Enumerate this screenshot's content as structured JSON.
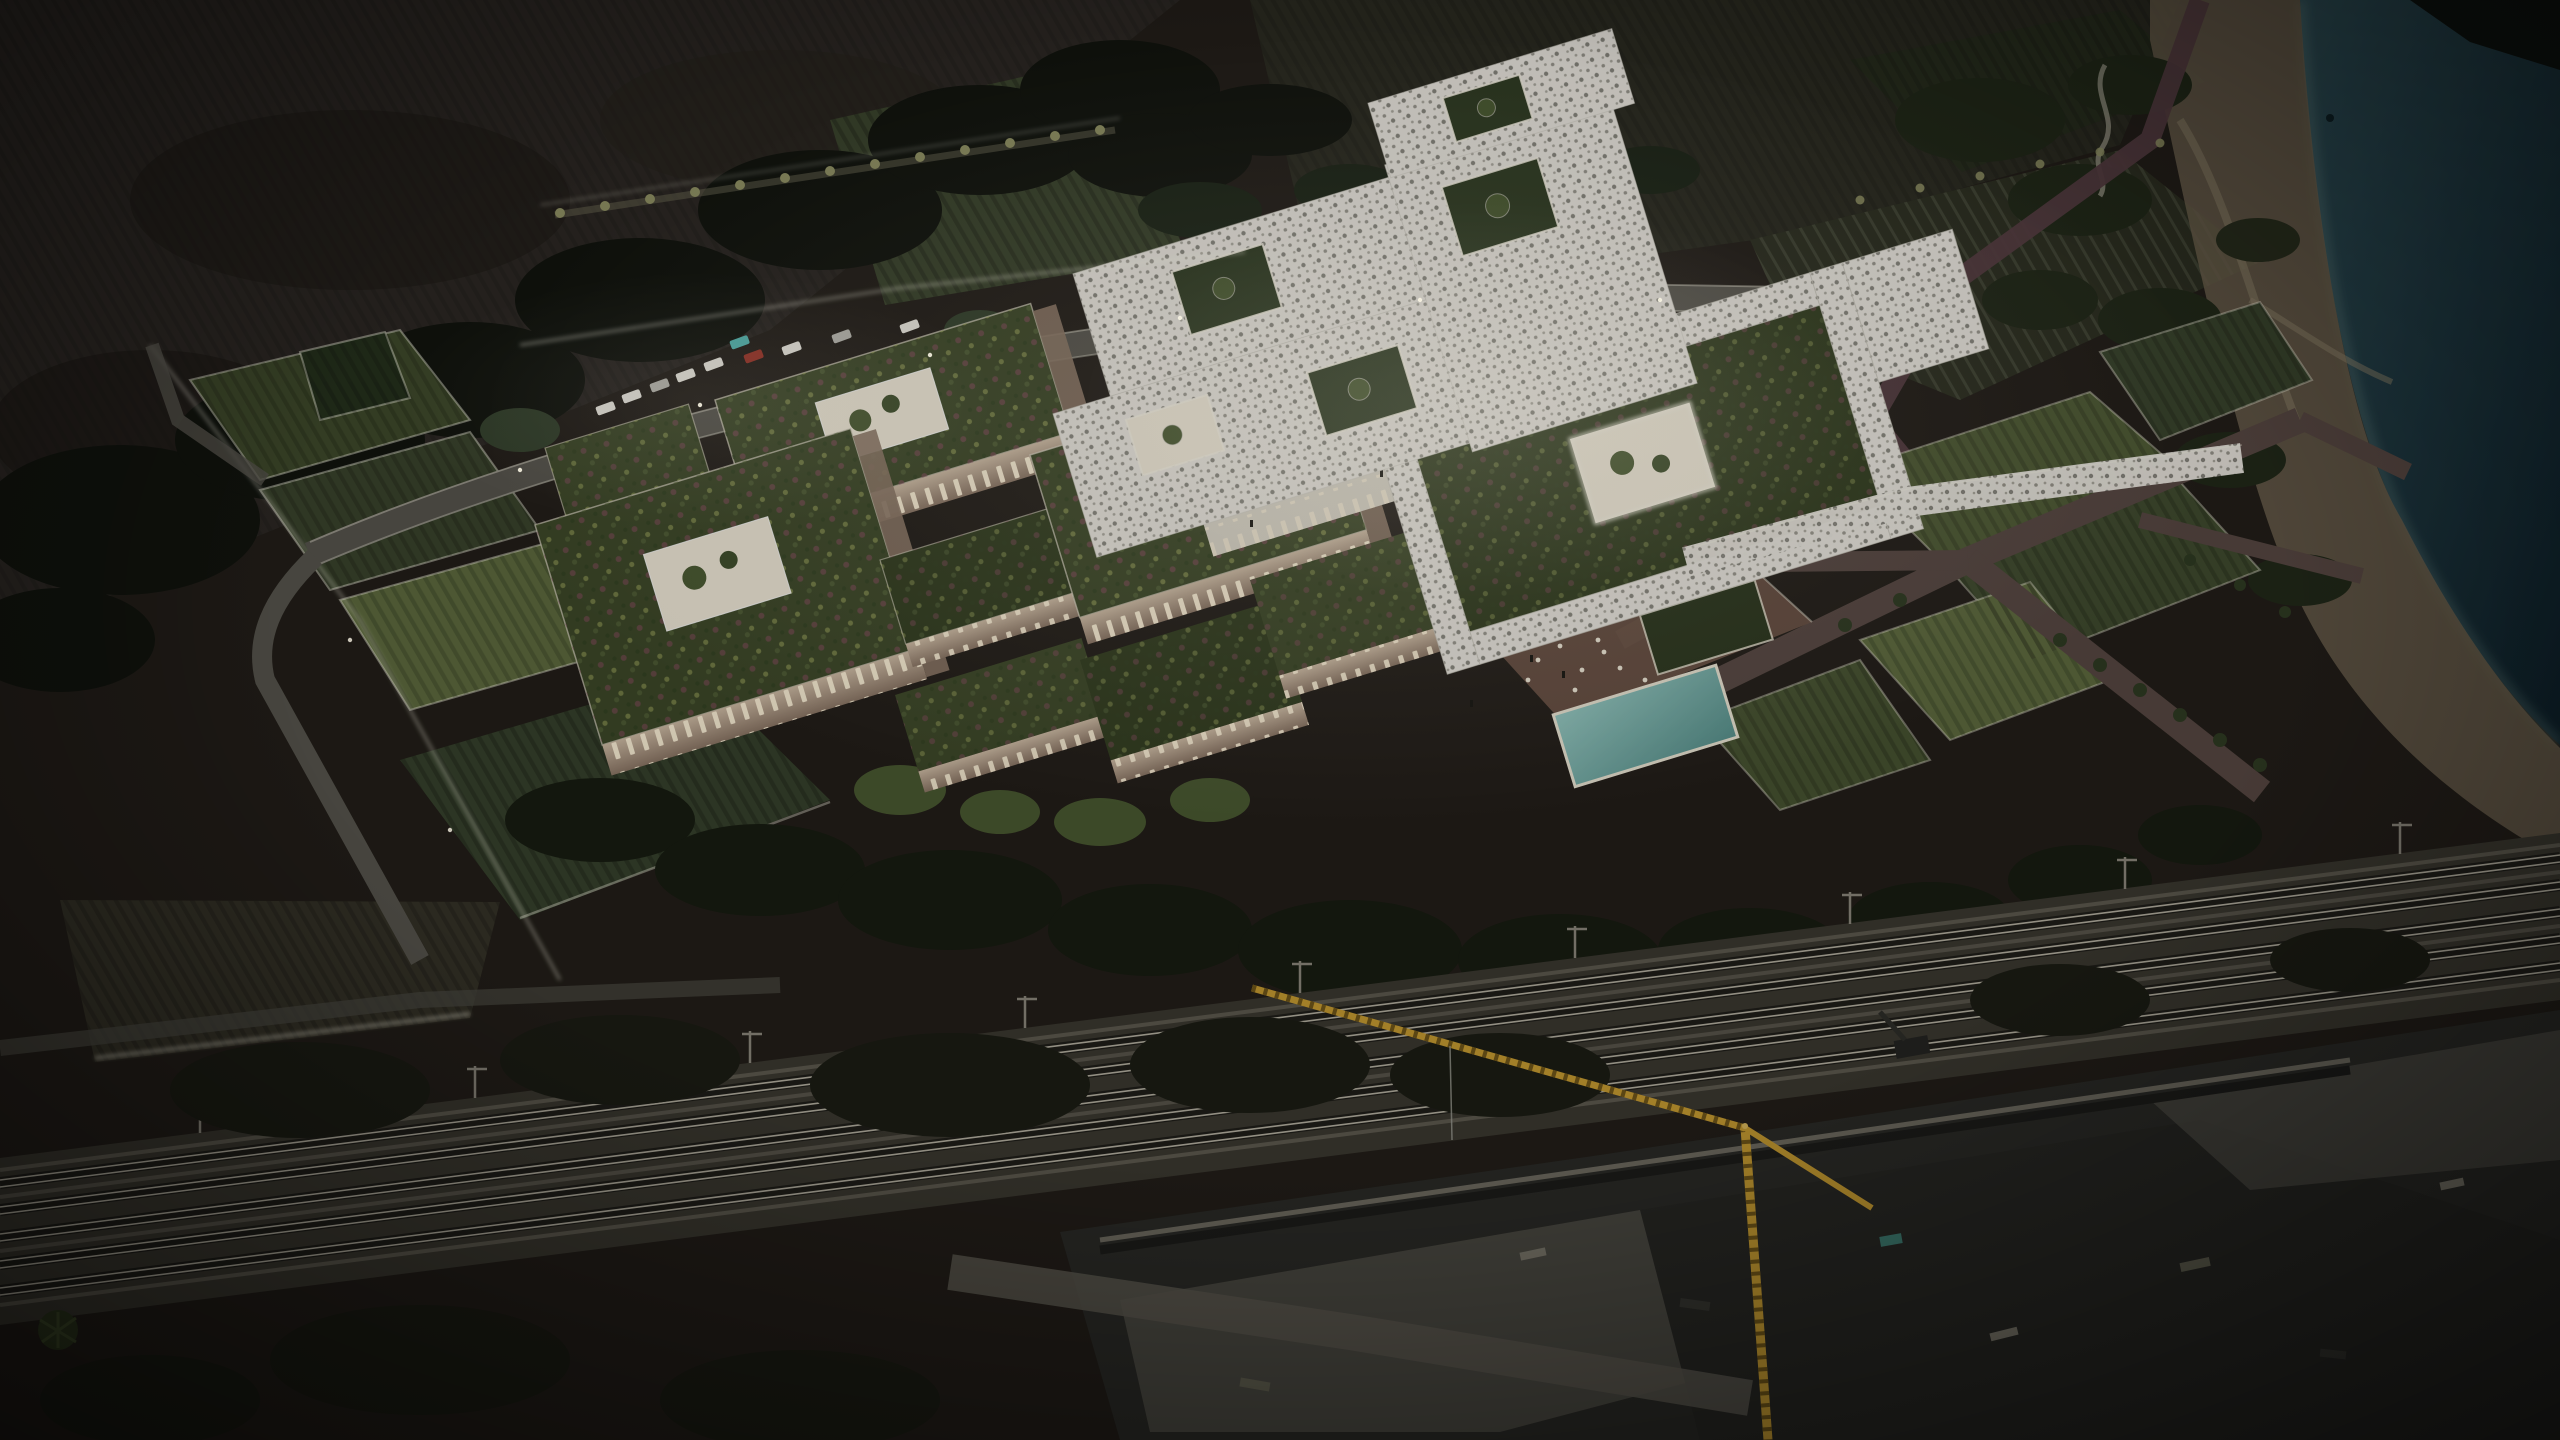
{
  "scene": {
    "type": "night aerial architectural rendering",
    "features": [
      "plowed-fields",
      "scrub-forest",
      "crop-row-plots",
      "palm-allee",
      "campus-courtyard-buildings",
      "green-roofs",
      "white-lattice-canopy",
      "courtyard-palms",
      "main-road",
      "parking-lot",
      "cars",
      "swimming-pool",
      "pool-terrace",
      "cafe-tables",
      "orchard-gardens",
      "terracotta-paths",
      "coastal-dunes",
      "sea",
      "shore-boardwalk",
      "railway-corridor",
      "catenary-masts",
      "construction-site",
      "tower-crane",
      "retaining-walls",
      "perimeter-light-walls"
    ]
  },
  "palette": {
    "earth": "#211d16",
    "field_plowed": "#2b2721",
    "field_stripe": "#383228",
    "scrub_dark": "#10130c",
    "field_green": "#2b2e1f",
    "vine_green": "#39422a",
    "crop_lit": "#5d6a3c",
    "sea_light": "#2c4b52",
    "sea_deep": "#0d2028",
    "surf": "#6c8a84",
    "sand": "#6a5e4a",
    "sand_path": "#8d8168",
    "boardwalk": "#533b3e",
    "road": "#56544b",
    "road_edge": "#d9d5c2",
    "path_mauve": "#564640",
    "terrace": "#6b5244",
    "wall_light": "#cdbaa2",
    "wall_shade": "#8a7563",
    "window": "#fff3d8",
    "green_roof": "#3c4726",
    "green_roof_dark": "#313c1e",
    "roof_flower_a": "#7e4c59",
    "roof_flower_b": "#96a058",
    "courtyard": "#efe8d6",
    "canopy": "#e8e5dc",
    "pool_light": "#93c7bf",
    "pool_deep": "#56908a",
    "lawn_dark": "#2a351c",
    "tree_dark": "#161b0f",
    "tree_mid": "#2e3a20",
    "tree_lit": "#49582f",
    "palm_lit": "#8f9162",
    "glow": "#f7f3e2",
    "ballast": "#3a372e",
    "rail_bright": "#b2ae9e",
    "track_bed": "#1e1d17",
    "gravel_lit": "#6b675a",
    "concrete": "#4e4c43",
    "concrete_dark": "#2a2a25",
    "wall_top": "#6e6b5f",
    "crane_yellow": "#c59a2f",
    "crane_dark": "#6e5517",
    "car_white": "#eceae0",
    "car_silver": "#b9b8af",
    "car_dark": "#2e2e2a",
    "car_red": "#9c3427",
    "car_cyan": "#53b7b0",
    "people": "#17150f"
  }
}
